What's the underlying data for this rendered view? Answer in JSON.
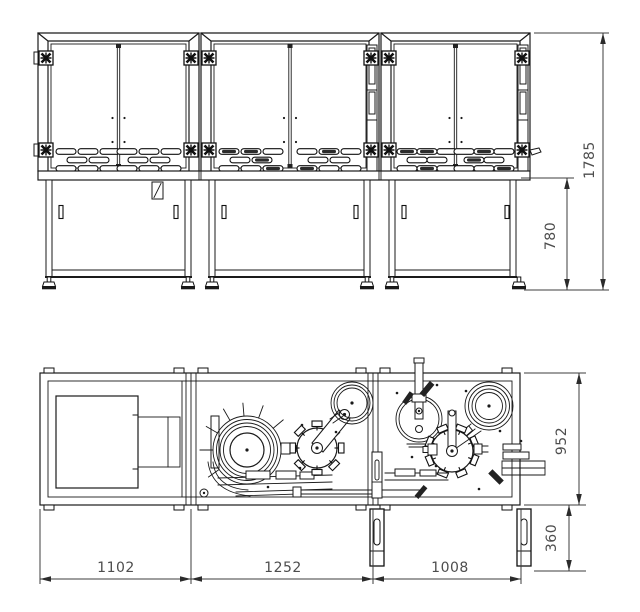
{
  "dimensions": {
    "height_overall": "1785",
    "height_base_cabinet": "780",
    "depth_body": "952",
    "depth_leg_offset": "360",
    "width_module1": "1102",
    "width_module2": "1252",
    "width_module3": "1008"
  },
  "colors": {
    "line": "#1a1a1a",
    "dimension_line": "#3c3c3c",
    "dimension_text": "#4d4d4d",
    "background": "#ffffff"
  }
}
